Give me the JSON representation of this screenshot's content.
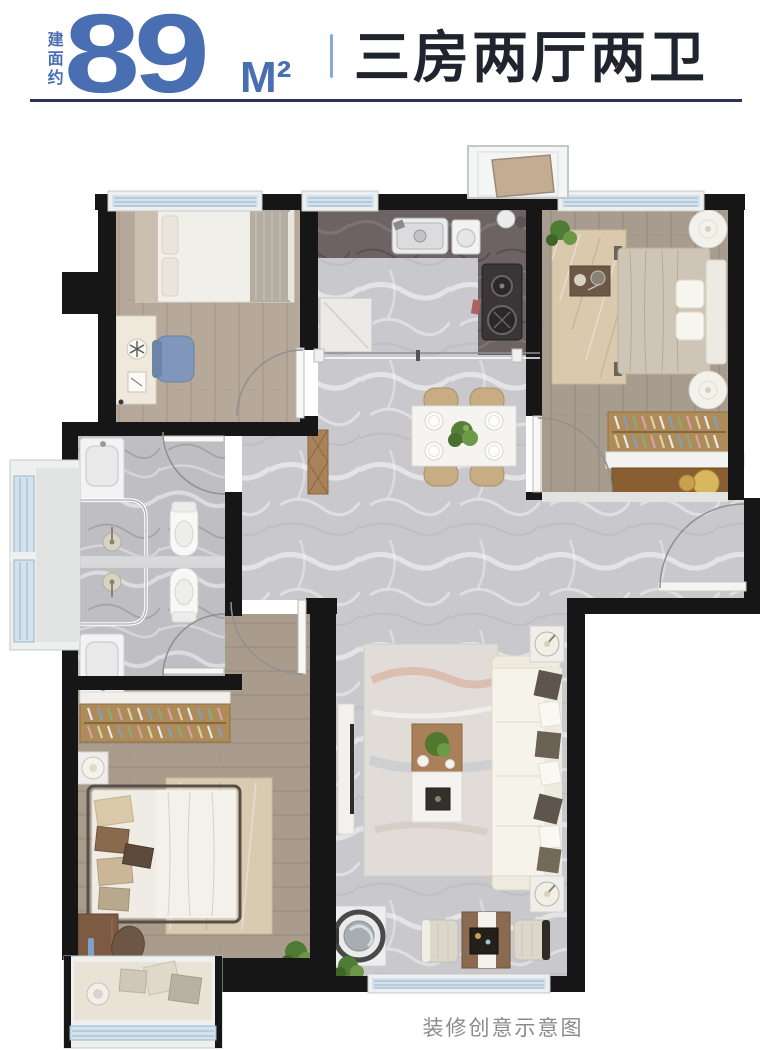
{
  "header": {
    "area_prefix": "建面约",
    "area_value": "89",
    "area_unit": "M²",
    "layout_title": "三房两厅两卫",
    "accent_color": "#4a6eb2",
    "title_color": "#20242f",
    "divider_color": "#8ca9d4",
    "rule_color": "#2b3252"
  },
  "caption": {
    "text": "装修创意示意图",
    "color": "#8b8b8b"
  },
  "floor_plan": {
    "type": "apartment-floor-plan-top-view",
    "wall_color": "#161616",
    "floor_colors": {
      "marble_hall": "#c9c8cc",
      "marble_bath": "#bfbec3",
      "wood_bedroom_top_left": "#b6a999",
      "wood_bedroom_top_right": "#a89c8e",
      "wood_bedroom_bottom_left": "#a99c8d",
      "kitchen_counter": "#6d6365",
      "window_glass": "#d3e2ec",
      "window_frame": "#eef0f0"
    },
    "rooms": [
      {
        "id": "bedroom-top-left",
        "furniture": [
          "single-bed",
          "desk-with-fan",
          "blue-chair",
          "swing-door"
        ]
      },
      {
        "id": "kitchen",
        "furniture": [
          "sink",
          "cooktop-two-burners",
          "fridge",
          "kettle",
          "sliding-door-track"
        ]
      },
      {
        "id": "dining-area",
        "furniture": [
          "dining-table",
          "four-chairs",
          "four-plates",
          "plant-centerpiece"
        ]
      },
      {
        "id": "bedroom-top-right",
        "furniture": [
          "double-bed",
          "two-round-nightstands",
          "rug-with-tray",
          "wardrobe-hangers",
          "dresser",
          "plant",
          "swing-door"
        ]
      },
      {
        "id": "bathrooms-stacked",
        "furniture": [
          "two-sinks",
          "two-showers-glass",
          "two-toilets",
          "bay-window",
          "two-swing-doors"
        ]
      },
      {
        "id": "bedroom-bottom-left",
        "furniture": [
          "wardrobe-hangers",
          "double-bed",
          "rug",
          "nightstand-lamp",
          "desk",
          "chair",
          "plant",
          "bay-window-seat",
          "swing-door"
        ]
      },
      {
        "id": "living-room",
        "furniture": [
          "tv-console",
          "area-rug",
          "coffee-table",
          "sectional-sofa",
          "two-lamp-side-tables",
          "washing-machine",
          "two-armchairs",
          "tea-table",
          "plants",
          "entry-swing-door"
        ]
      }
    ],
    "windows": [
      "top-bedroom-left",
      "top-kitchen",
      "top-bedroom-right",
      "left-bay-double",
      "bottom-left-bay-seat",
      "bottom-balcony"
    ],
    "exterior_feature": "flue-box-above-kitchen"
  }
}
